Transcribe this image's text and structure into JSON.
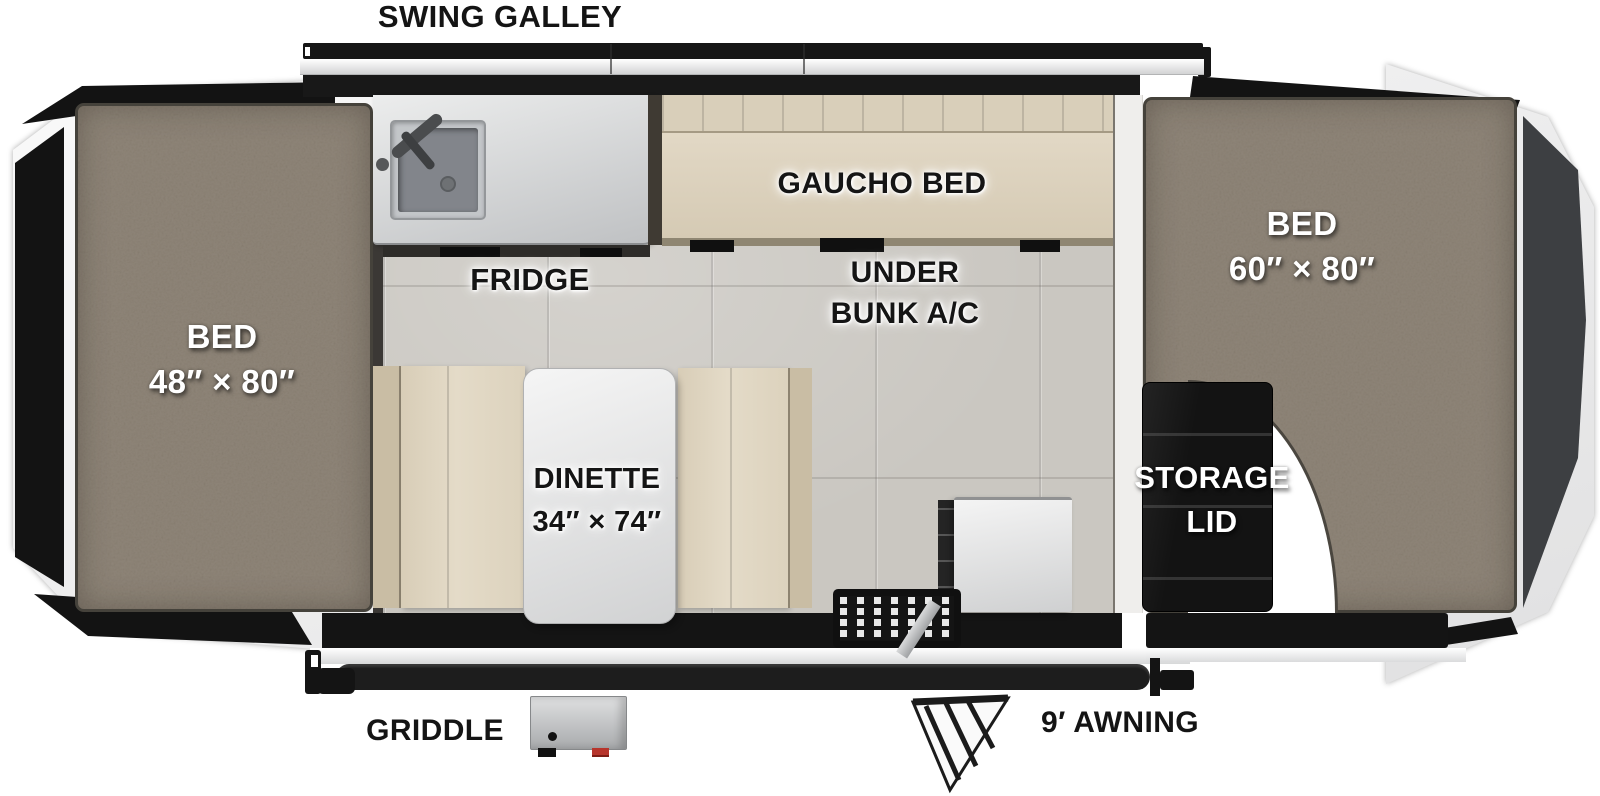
{
  "floorplan": {
    "labels": {
      "swing_galley": "SWING GALLEY",
      "griddle": "GRIDDLE",
      "awning": "9′ AWNING",
      "fridge": "FRIDGE",
      "gaucho_bed": "GAUCHO BED",
      "under_bunk_line1": "UNDER",
      "under_bunk_line2": "BUNK A/C",
      "bed_left_name": "BED",
      "bed_left_size": "48″ × 80″",
      "bed_right_name": "BED",
      "bed_right_size": "60″ × 80″",
      "dinette_name": "DINETTE",
      "dinette_size": "34″ × 74″",
      "storage_line1": "STORAGE",
      "storage_line2": "LID"
    },
    "colors": {
      "carpet": "#8D8478",
      "floor_tile": "#CAC7C1",
      "upholstery": "#DFD5C1",
      "counter": "#D7D9DB",
      "panel_black": "#141414",
      "end_cap_gray": "#3D3F42",
      "accent_red": "#B7352C"
    }
  }
}
